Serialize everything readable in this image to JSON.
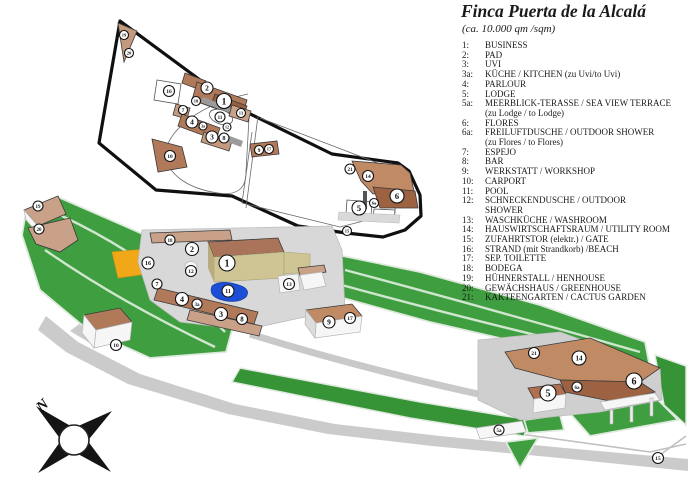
{
  "title": "Finca Puerta de la Alcalá",
  "subtitle": "(ca. 10.000 qm /sqm)",
  "compass": {
    "label": "N"
  },
  "legend": {
    "items": [
      {
        "no": "1:",
        "label": "BUSINESS"
      },
      {
        "no": "2:",
        "label": "PAD"
      },
      {
        "no": "3:",
        "label": "UVI"
      },
      {
        "no": "3a:",
        "label": "KÜCHE / KITCHEN (zu Uvi/to Uvi)"
      },
      {
        "no": "4:",
        "label": "PARLOUR"
      },
      {
        "no": "5:",
        "label": "LODGE"
      },
      {
        "no": "5a:",
        "label": "MEERBLICK-TERASSE / SEA VIEW TERRACE",
        "sub": "(zu Lodge / to Lodge)"
      },
      {
        "no": "6:",
        "label": "FLORES"
      },
      {
        "no": "6a:",
        "label": "FREILUFTDUSCHE / OUTDOOR SHOWER",
        "sub": "(zu Flores / to Flores)"
      },
      {
        "no": "7:",
        "label": "ESPEJO"
      },
      {
        "no": "8:",
        "label": "BAR"
      },
      {
        "no": "9:",
        "label": "WERKSTATT / WORKSHOP"
      },
      {
        "no": "10:",
        "label": "CARPORT"
      },
      {
        "no": "11:",
        "label": "POOL"
      },
      {
        "no": "12:",
        "label": "SCHNECKENDUSCHE / OUTDOOR",
        "sub": "SHOWER"
      },
      {
        "no": "13:",
        "label": "WASCHKÜCHE / WASHROOM"
      },
      {
        "no": "14:",
        "label": "HAUSWIRTSCHAFTSRAUM / UTILITY ROOM"
      },
      {
        "no": "15:",
        "label": "ZUFAHRTSTOR (elektr.) / GATE"
      },
      {
        "no": "16:",
        "label": "STRAND (mit Strandkorb) /BEACH"
      },
      {
        "no": "17:",
        "label": "SEP. TOILETTE"
      },
      {
        "no": "18:",
        "label": "BODEGA"
      },
      {
        "no": "19:",
        "label": "HÜHNERSTALL / HENHOUSE"
      },
      {
        "no": "20:",
        "label": "GEWÄCHSHAUS / GREENHOUSE"
      },
      {
        "no": "21:",
        "label": "KAKTEENGARTEN / CACTUS GARDEN"
      }
    ]
  },
  "outline_plan": {
    "markers": [
      {
        "n": "19",
        "x": 124,
        "y": 35,
        "r": 4.5
      },
      {
        "n": "20",
        "x": 129,
        "y": 53,
        "r": 4.5
      },
      {
        "n": "16",
        "x": 169,
        "y": 91,
        "r": 5.5
      },
      {
        "n": "2",
        "x": 207,
        "y": 88,
        "r": 6
      },
      {
        "n": "1",
        "x": 224,
        "y": 101,
        "r": 7.5
      },
      {
        "n": "18",
        "x": 196,
        "y": 101,
        "r": 4.5
      },
      {
        "n": "7",
        "x": 183,
        "y": 110,
        "r": 4.5
      },
      {
        "n": "13",
        "x": 241,
        "y": 113,
        "r": 4.5
      },
      {
        "n": "11",
        "x": 220,
        "y": 117,
        "r": 5
      },
      {
        "n": "4",
        "x": 192,
        "y": 122,
        "r": 6
      },
      {
        "n": "3a",
        "x": 203,
        "y": 126,
        "r": 4
      },
      {
        "n": "12",
        "x": 227,
        "y": 127,
        "r": 4
      },
      {
        "n": "3",
        "x": 212,
        "y": 137,
        "r": 6
      },
      {
        "n": "8",
        "x": 224,
        "y": 138,
        "r": 5
      },
      {
        "n": "9",
        "x": 259,
        "y": 150,
        "r": 4.5
      },
      {
        "n": "17",
        "x": 269,
        "y": 149,
        "r": 4.5
      },
      {
        "n": "10",
        "x": 170,
        "y": 156,
        "r": 5.5
      },
      {
        "n": "21",
        "x": 350,
        "y": 169,
        "r": 5
      },
      {
        "n": "14",
        "x": 368,
        "y": 176,
        "r": 5.5
      },
      {
        "n": "6",
        "x": 397,
        "y": 196,
        "r": 7
      },
      {
        "n": "6a",
        "x": 374,
        "y": 203,
        "r": 4.5
      },
      {
        "n": "5",
        "x": 359,
        "y": 208,
        "r": 7
      },
      {
        "n": "15",
        "x": 347,
        "y": 231,
        "r": 4.5
      }
    ]
  },
  "perspective_plan": {
    "markers": [
      {
        "n": "19",
        "x": 38,
        "y": 206,
        "r": 5
      },
      {
        "n": "20",
        "x": 39,
        "y": 229,
        "r": 5
      },
      {
        "n": "18",
        "x": 170,
        "y": 240,
        "r": 5
      },
      {
        "n": "2",
        "x": 192,
        "y": 249,
        "r": 6.5
      },
      {
        "n": "16",
        "x": 148,
        "y": 263,
        "r": 6
      },
      {
        "n": "1",
        "x": 227,
        "y": 263,
        "r": 8
      },
      {
        "n": "12",
        "x": 191,
        "y": 271,
        "r": 5.5
      },
      {
        "n": "7",
        "x": 157,
        "y": 284,
        "r": 5
      },
      {
        "n": "13",
        "x": 289,
        "y": 284,
        "r": 5.5
      },
      {
        "n": "11",
        "x": 228,
        "y": 291,
        "r": 6
      },
      {
        "n": "4",
        "x": 182,
        "y": 299,
        "r": 6.5
      },
      {
        "n": "3a",
        "x": 197,
        "y": 304,
        "r": 5
      },
      {
        "n": "3",
        "x": 221,
        "y": 314,
        "r": 6.5
      },
      {
        "n": "8",
        "x": 242,
        "y": 319,
        "r": 5.5
      },
      {
        "n": "17",
        "x": 350,
        "y": 318,
        "r": 5.5
      },
      {
        "n": "9",
        "x": 329,
        "y": 322,
        "r": 6
      },
      {
        "n": "10",
        "x": 116,
        "y": 345,
        "r": 5.5
      },
      {
        "n": "21",
        "x": 534,
        "y": 353,
        "r": 5.5
      },
      {
        "n": "14",
        "x": 579,
        "y": 358,
        "r": 7
      },
      {
        "n": "6",
        "x": 634,
        "y": 381,
        "r": 8
      },
      {
        "n": "6a",
        "x": 577,
        "y": 387,
        "r": 5
      },
      {
        "n": "5",
        "x": 548,
        "y": 393,
        "r": 8
      },
      {
        "n": "5a",
        "x": 499,
        "y": 430,
        "r": 5
      },
      {
        "n": "15",
        "x": 658,
        "y": 458,
        "r": 5.5
      }
    ]
  },
  "colors": {
    "land_green": "#3f9e3f",
    "path_light": "#cfe6cf",
    "roof_tan": "#c08a64",
    "roof_brown": "#b07a5a",
    "roof_dark": "#9c6242",
    "wall_khaki": "#cfc493",
    "platform_gray": "#d8d8d8",
    "pool_blue": "#1d4fd6",
    "beach_orange": "#f0a818",
    "outline_black": "#101010"
  }
}
